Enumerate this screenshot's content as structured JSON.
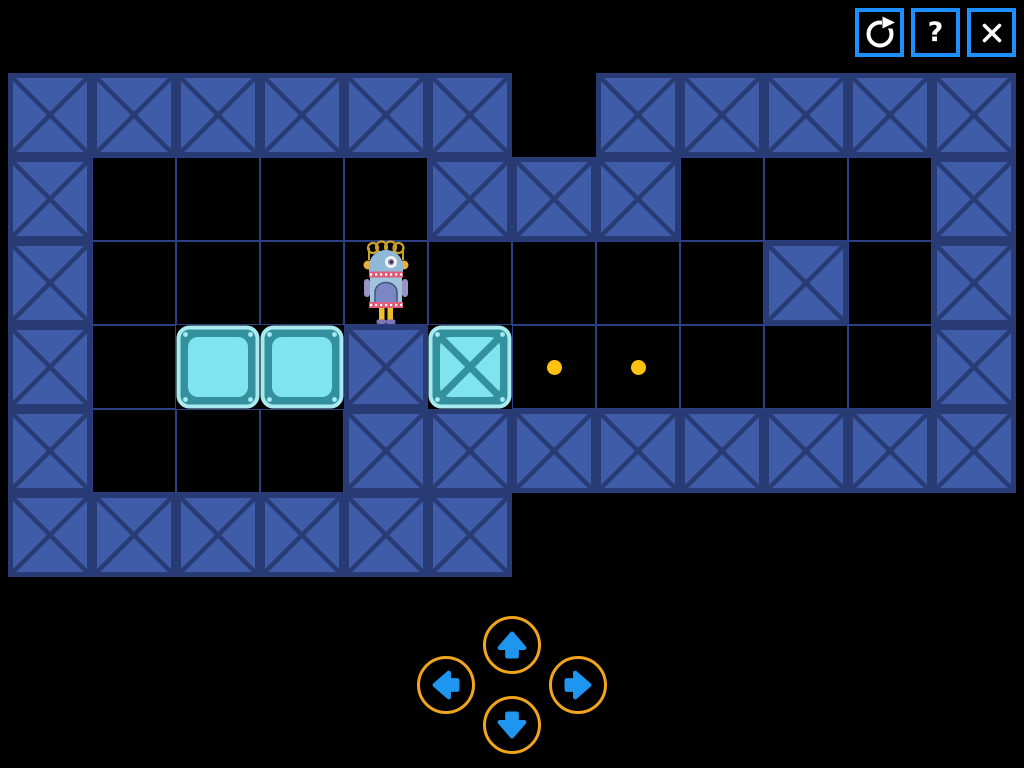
{
  "toolbar": {
    "buttons": [
      {
        "id": "restart",
        "icon": "restart-icon",
        "label": ""
      },
      {
        "id": "help",
        "icon": "question-icon",
        "label": "?"
      },
      {
        "id": "close",
        "icon": "close-icon",
        "label": ""
      }
    ]
  },
  "board": {
    "rows": 6,
    "cols": 12,
    "grid": [
      "WWWWWWOWWWWW",
      "WFFFFWWWFFFW",
      "WFFFRFFFFWFW",
      "WFBBWXDDFFFW",
      "WFFFWWWWWWWW",
      "WWWWWWOOOOOO"
    ],
    "legend": {
      "W": "wall",
      "F": "floor",
      "O": "outside",
      "B": "crate",
      "X": "crate-with-x",
      "D": "goal-dot",
      "R": "robot"
    }
  },
  "dpad": {
    "buttons": [
      {
        "dir": "up"
      },
      {
        "dir": "left"
      },
      {
        "dir": "right"
      },
      {
        "dir": "down"
      }
    ]
  },
  "colors": {
    "button_border": "#1E8FFF",
    "icon": "#FFFFFF",
    "wall_fill": "#3E5CA7",
    "wall_line": "#293B74",
    "grid_line": "#2B3F85",
    "box_frame": "#33919E",
    "box_face": "#7FE4EE",
    "box_rim": "#A8EAEF",
    "dot": "#FFC20E",
    "dpad_ring": "#F2A51C",
    "arrow": "#1E96F0"
  },
  "robot": {
    "head": "#8FB9D6",
    "body": "#9FC4DC",
    "apron": "#7B87C4",
    "apron_line": "#46517E",
    "collar": "#E05A78",
    "collar_dash": "#FFFFFF",
    "arms": "#9A93C8",
    "legs": "#EDBE2A",
    "feet": "#7F74B8",
    "coil": "#C9A227",
    "ear": "#E8AC3F",
    "eye_white": "#F2F2F2",
    "iris": "#8C84B8",
    "pupil": "#333333"
  }
}
